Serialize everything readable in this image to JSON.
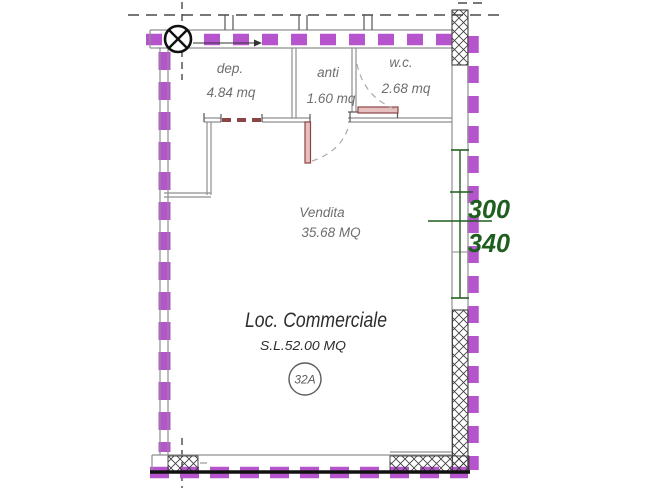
{
  "plan": {
    "rooms": [
      {
        "name": "dep.",
        "area": "4.84 mq"
      },
      {
        "name": "anti",
        "area": "1.60 mq"
      },
      {
        "name": "w.c.",
        "area": "2.68 mq"
      },
      {
        "name": "Vendita",
        "area": "35.68 MQ"
      }
    ],
    "label": {
      "title": "Loc. Commerciale",
      "subtitle": "S.L.52.00 MQ",
      "unit": "32A"
    },
    "dimensions": {
      "dim_top": "300",
      "dim_bottom": "340"
    },
    "colors": {
      "boundary": "#b654cd",
      "dimension": "#1e5e1e",
      "door": "#8c4444",
      "wall": "#8f8f8f"
    }
  }
}
